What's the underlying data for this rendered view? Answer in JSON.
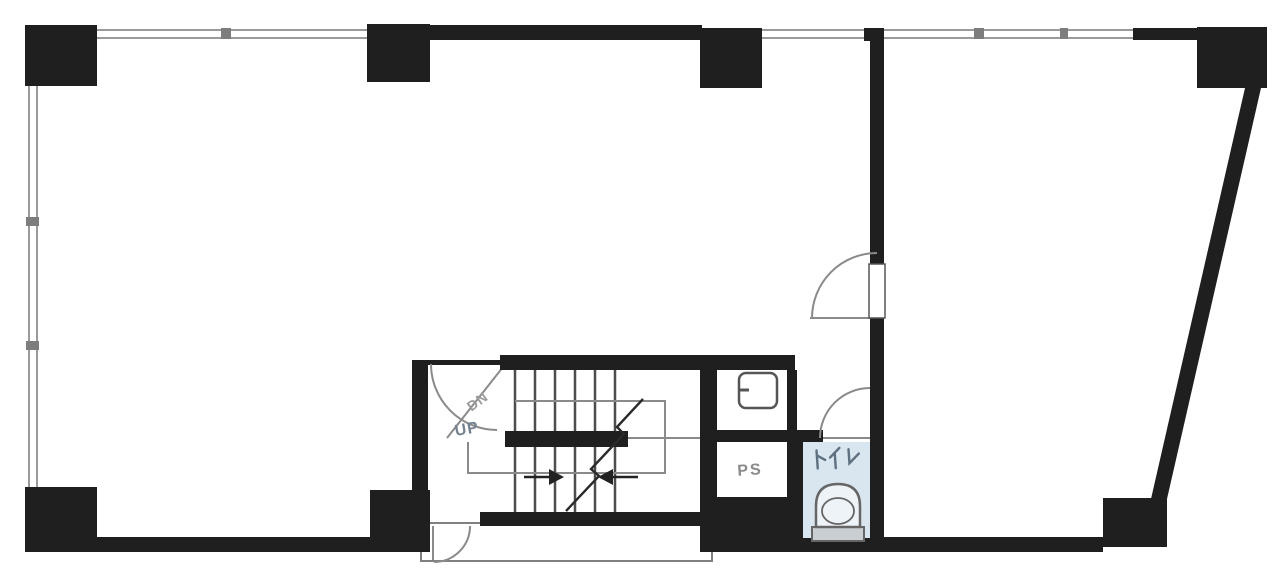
{
  "plan": {
    "labels": {
      "down": "DN",
      "up": "UP",
      "pipe_shaft": "PS",
      "toilet": "トイレ"
    }
  },
  "icons": {
    "toilet_fixture": "toilet-bowl-icon",
    "small_room_fixture": "wash-basin-icon",
    "stair_direction": "stair-arrow-icons",
    "doors": "door-swing-arc"
  },
  "colors": {
    "background": "#ffffff",
    "wall": "#1f1f1f",
    "thin_line": "#8a8a8a",
    "window_line": "#9a9a9a",
    "tread_line": "#4d4d4d",
    "toilet_floor": "#d9e6f0",
    "toilet_tank": "#c9ced3",
    "label_dn": "#9b9b9b",
    "label_up": "#76818f",
    "label_ps": "#8a8a8a",
    "label_toilet": "#5f7080"
  }
}
